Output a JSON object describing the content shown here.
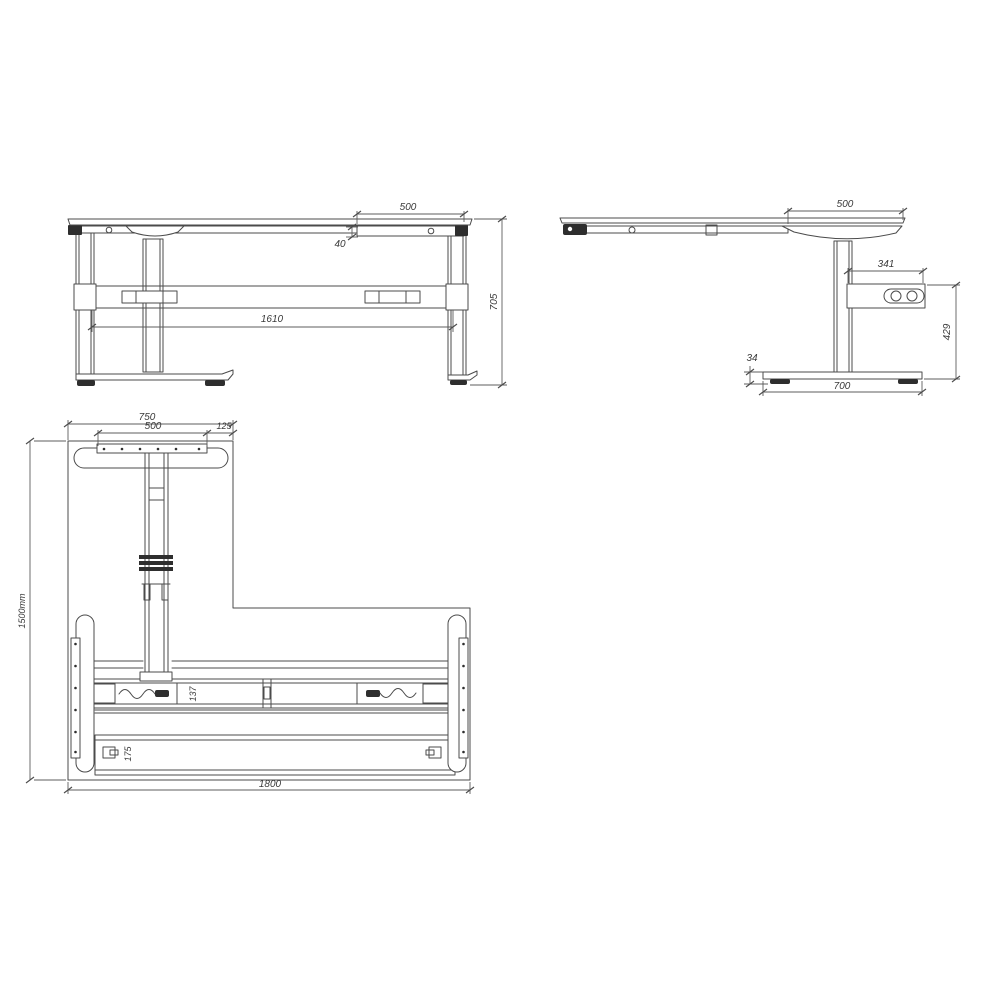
{
  "drawing": {
    "subject": "Height-adjustable L-shaped desk frame",
    "kind": "CAD dimensional drawing with three orthographic views",
    "units": "mm",
    "line_color": "#4b4b4b",
    "text_color": "#3a3a3a",
    "background": "#ffffff"
  },
  "front_view": {
    "dim_top_section": "500",
    "dim_frame_height": "40",
    "dim_leg_span": "1610",
    "dim_overall_height": "705"
  },
  "side_view": {
    "dim_top_overhang": "500",
    "dim_control_box_length": "341",
    "dim_box_to_floor": "429",
    "dim_foot_height": "34",
    "dim_foot_depth": "700"
  },
  "plan_view": {
    "dim_return_width": "750",
    "dim_foot_plate_width": "500",
    "dim_edge_offset": "125",
    "dim_overall_depth": "1500mm",
    "dim_beam_depth": "137",
    "dim_rail_depth": "175",
    "dim_overall_width": "1800"
  }
}
